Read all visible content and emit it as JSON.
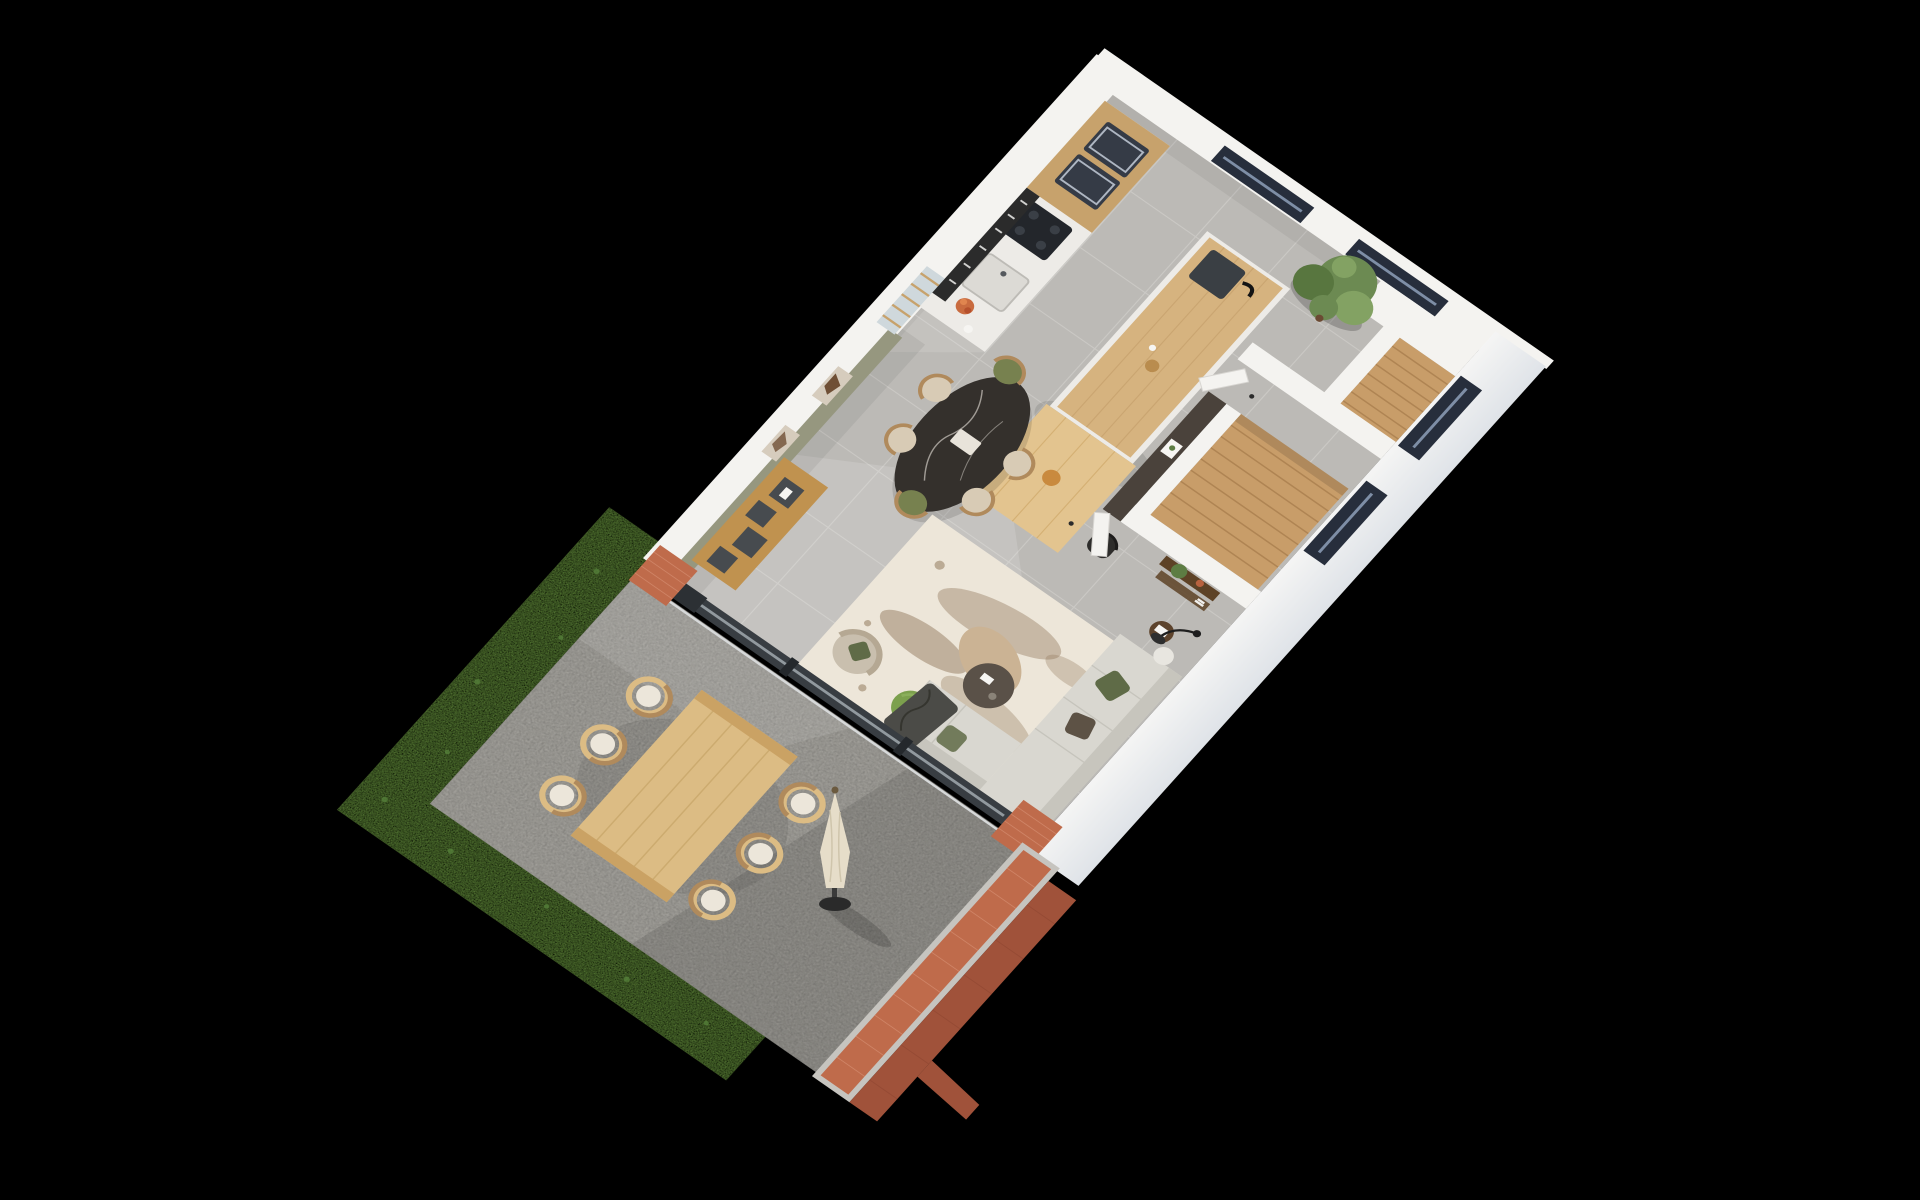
{
  "scene": {
    "label": "3D isometric floor plan rendering of a ground floor with kitchen, dining area, stair hall, living room and terrace",
    "rooms": [
      "kitchen",
      "dining-area",
      "stair-hall",
      "living-area",
      "terrace",
      "garden"
    ],
    "objects": [
      "kitchen-counter-with-ovens-and-cooktop",
      "kitchen-wall-rack",
      "kitchen-island-with-sink",
      "island-wood-table-with-black-chairs",
      "corner-tree",
      "black-oval-dining-table",
      "green-dining-chairs",
      "beige-dining-chairs",
      "wood-sideboard",
      "green-accent-wall-with-artwork",
      "white-partition-walls",
      "dark-partition-wall-with-frame",
      "wood-staircase",
      "upper-stair-flight",
      "console-shelves-with-plant",
      "interior-doors",
      "area-rug",
      "organic-coffee-table",
      "green-pouf",
      "beige-armchair",
      "l-shaped-sofa-with-pillows",
      "arc-floor-lamp",
      "side-table",
      "sliding-glass-door",
      "brick-pillars",
      "outdoor-dining-table",
      "outdoor-chairs-with-cushions",
      "closed-parasol",
      "brick-garden-wall",
      "grass-border",
      "windows-dark-frames"
    ]
  },
  "canvas": {
    "width": 1920,
    "height": 1200
  },
  "palette": {
    "background": "#000000",
    "floor": "#bcbab6",
    "floor_line": "#d6d4d0",
    "paving": "#b1afa9",
    "grass": "#6e9a44",
    "grass_dark": "#55803a",
    "wall": "#f4f3f0",
    "wall_face": "#e3e6ea",
    "accent_wall": "#96977f",
    "dark_partition": "#4a423b",
    "brick": "#bf6b4b",
    "brick_dark": "#a0523a",
    "mortar": "#dd9a7e",
    "coping": "#c6c4bf",
    "window_frame": "#272e3c",
    "glass": "#7e8ea6",
    "wood_counter": "#c7a26c",
    "counter": "#edebe7",
    "appliance": "#353b46",
    "steel": "#aeb6c2",
    "rack": "#2b2b2b",
    "island_top": "#d6b37f",
    "island_wood_light": "#e3c48f",
    "table_black": "#34302c",
    "chair_green": "#77814f",
    "chair_beige": "#d8cbb5",
    "chair_wood": "#b08a5c",
    "black_chair": "#2e2d2b",
    "sofa": "#d9d7d0",
    "sofa_shade": "#c7c5bd",
    "pillow_green": "#5f6b47",
    "pillow_brown": "#5d5245",
    "throw": "#4b4b47",
    "rug": "#ede6d9",
    "rug_pattern": "#8a6f52",
    "pouf": "#7ca04d",
    "armchair": "#c9bfae",
    "coffee_top": "#cbb394",
    "coffee_dark": "#5a5148",
    "stair_wood": "#c89d69",
    "stair_line": "#a97f4e",
    "console_wood": "#5d4226",
    "plant_green": "#5d7d43",
    "terracotta": "#b8623f",
    "outdoor_wood": "#dcbc84",
    "outdoor_line": "#c9a76b",
    "cushion": "#ece6da",
    "parasol": "#e6ddc9",
    "tree_dark": "#58763f",
    "tree_mid": "#6c8a52",
    "tree_light": "#83a263",
    "trunk": "#6b4a33",
    "sideboard_wood": "#c0924f",
    "shelf_dark": "#474b4f",
    "door_glass_frame": "#383d42",
    "track": "#d7d9da",
    "art_bg": "#d6ccbd",
    "art_blob": "#6f4f35",
    "white_decor": "#f6f5f2"
  }
}
